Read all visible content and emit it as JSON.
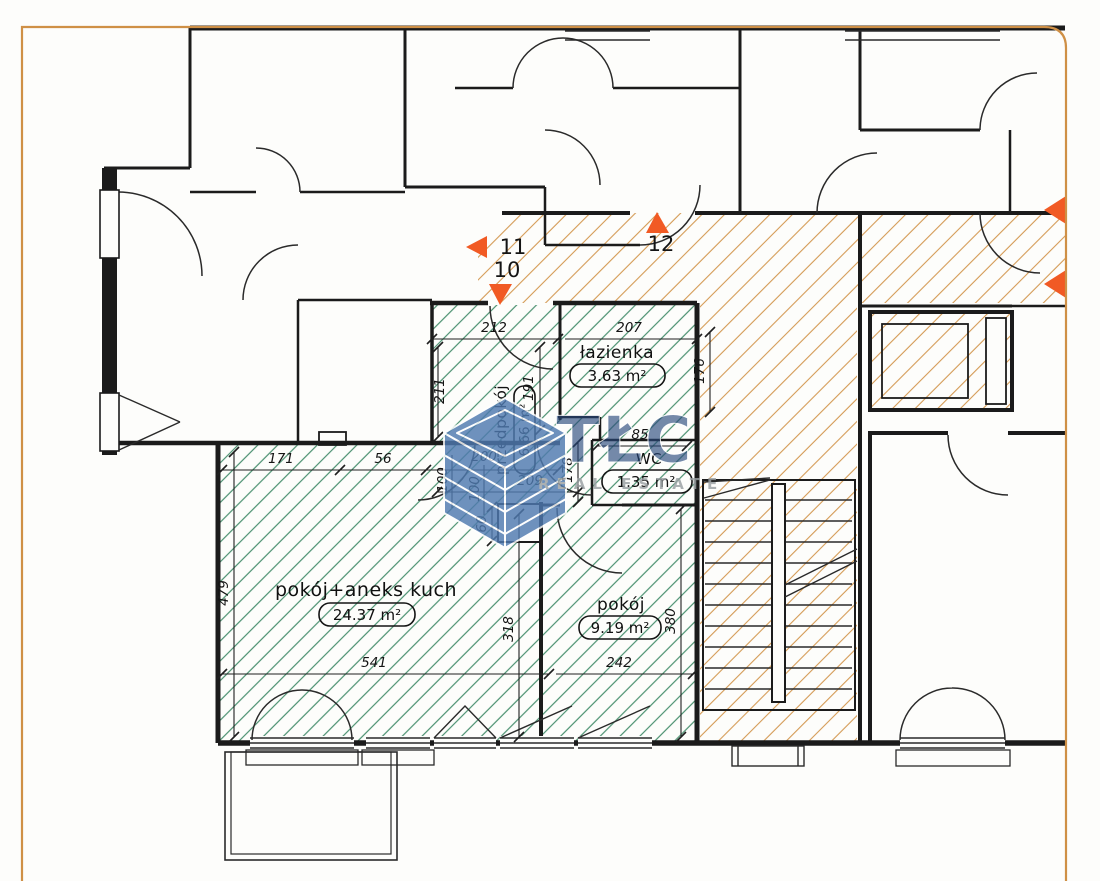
{
  "plan": {
    "title": "Rzut kondygnacji — mieszkanie",
    "rooms": [
      {
        "id": "room-main",
        "name": "pokój+aneks kuch",
        "area": "24.37 m²"
      },
      {
        "id": "room-small",
        "name": "pokój",
        "area": "9.19 m²"
      },
      {
        "id": "bathroom",
        "name": "łazienka",
        "area": "3.63 m²"
      },
      {
        "id": "hallway",
        "name": "przedpokój",
        "area": "6.66 m²"
      },
      {
        "id": "wc",
        "name": "WC",
        "area": "1.35 m²"
      }
    ],
    "markers": [
      {
        "label": "10",
        "direction": "down"
      },
      {
        "label": "11",
        "direction": "left"
      },
      {
        "label": "12",
        "direction": "up"
      }
    ],
    "dimensions": {
      "d212": "212",
      "d207": "207",
      "d211": "211",
      "d191": "191",
      "d176": "176",
      "d85": "85",
      "d178": "178",
      "d209": "209",
      "d100a": "100",
      "d100b": "100",
      "d171": "171",
      "d56": "56",
      "d200": "200",
      "d60": "60",
      "d479": "479",
      "d318": "318",
      "d380": "380",
      "d541": "541",
      "d242": "242"
    },
    "watermark": {
      "brand": "TŁC",
      "subtitle": "REAL ESTATE"
    },
    "colors": {
      "hatch_green": "#4a9070",
      "hatch_orange": "#d49a55",
      "marker": "#f15a24",
      "page_border": "#cf9046",
      "watermark_blue": "#4f7ab0",
      "wall": "#1b1b1b"
    }
  }
}
